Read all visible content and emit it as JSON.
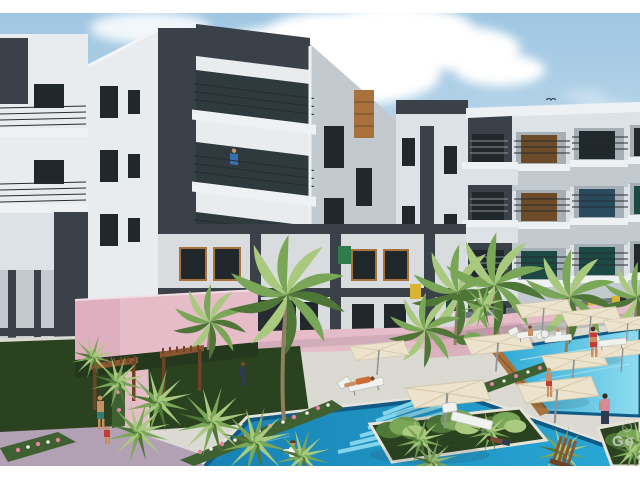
{
  "scene": {
    "kind": "3d-architectural-rendering",
    "watermark": "Go",
    "elements": [
      "sky",
      "clouds",
      "bird",
      "apartment-buildings",
      "balconies",
      "courtyard",
      "swimming-pools",
      "palm-trees",
      "sun-umbrellas",
      "pergolas",
      "sun-loungers",
      "people",
      "flower-beds",
      "pink-walkways",
      "lawn"
    ]
  },
  "palette": {
    "frame": "#ffffff",
    "sky_top": "#9fc6e2",
    "sky_mid": "#c8dfee",
    "sky_low": "#e2edf4",
    "cloud": "#ffffff",
    "wall_white": "#e9ecee",
    "wall_light": "#dde2e6",
    "wall_mid": "#c2c9cf",
    "wall_shadow": "#a6aeb6",
    "wall_dark": "#70787f",
    "charcoal": "#3a4148",
    "charcoal_deep": "#262c31",
    "win_dark": "#20282c",
    "win_teal": "#1d4944",
    "win_blue": "#2a4a5e",
    "win_brown": "#6e4b28",
    "wood": "#a9713c",
    "green_win": "#2e7d4a",
    "yellow_win": "#d8b430",
    "pav_pink": "#e6bcc9",
    "pav_rose": "#d9a7b8",
    "pav_mauve": "#b2a0b5",
    "deck": "#dad9d2",
    "deck_light": "#e6e4dc",
    "lawn": "#2a421f",
    "lawn_light": "#3f6030",
    "palm": "#7aa657",
    "palm_light": "#a8c97e",
    "palm_deep": "#4e7637",
    "trunk": "#8f7f62",
    "pool": "#2aa9d6",
    "pool_deep": "#1782b4",
    "pool_pale": "#8fdcef",
    "tile": "#125a86",
    "umbrella": "#ece3cd",
    "umbrella_shade": "#d5c8aa",
    "pergola": "#8a5530",
    "pergola_dark": "#6e4224",
    "skin": "#c98e63",
    "skin_dark": "#7a4a30",
    "red": "#c43b35",
    "teal_shorts": "#2e7d74",
    "blue_shirt": "#3a6fae",
    "pink_top": "#d98a96",
    "navy": "#2e3a52",
    "white": "#f4f6f6",
    "shadow": "#1c2a33",
    "watermark": "#c6cac6",
    "orange": "#cd6b35"
  }
}
